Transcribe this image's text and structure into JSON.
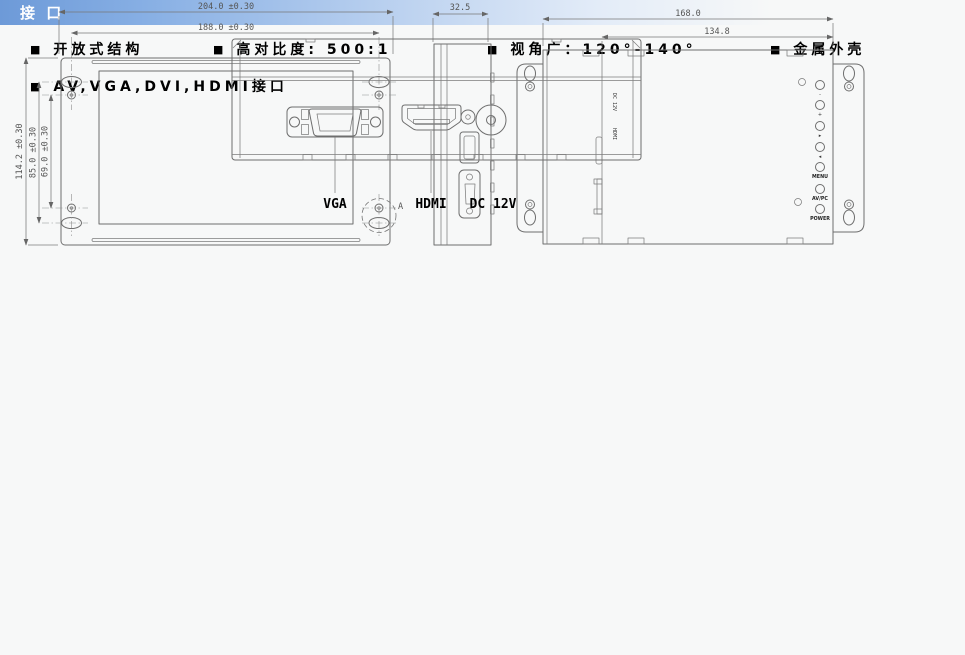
{
  "page": {
    "background": "#f7f8f8",
    "header_gradient_start": "#6d9ad8",
    "header_gradient_end": "#f7f8f8",
    "header_text_color": "#ffffff"
  },
  "sections": {
    "features": {
      "title": "产品特点",
      "bullet": "■",
      "row1": [
        "开放式结构",
        "高对比度: 500:1",
        "视角广：120°-140°",
        "金属外壳"
      ],
      "row2": [
        "AV,VGA,DVI,HDMI接口"
      ]
    },
    "dimensions": {
      "title": "尺 寸 图",
      "front_view": {
        "width_outer": "204.0 ±0.30",
        "width_inner": "188.0 ±0.30",
        "height_outer": "114.2 ±0.30",
        "height_mid": "85.0 ±0.30",
        "height_inner": "69.0 ±0.30",
        "detail_label": "A"
      },
      "side_view": {
        "depth": "32.5"
      },
      "rear_view": {
        "width_outer": "168.0",
        "width_inner": "134.8",
        "dc_label": "DC 12V",
        "hdmi_label": "HDMI",
        "button_glyphs": [
          "-",
          "+",
          "▸",
          "◂"
        ],
        "button_labels": [
          "MENU",
          "AV/PC",
          "POWER"
        ]
      }
    },
    "interface": {
      "title": "接 口",
      "port_labels": {
        "vga": "VGA",
        "hdmi": "HDMI",
        "dc": "DC 12V"
      }
    }
  }
}
